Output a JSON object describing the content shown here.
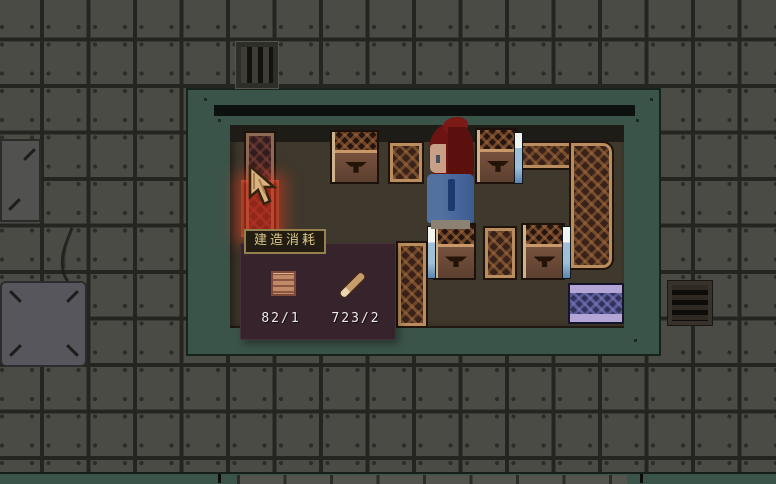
{
  "tooltip": {
    "title": "建造消耗",
    "items": [
      {
        "icon": "wood-plank-icon",
        "label": "82/1"
      },
      {
        "icon": "stick-icon",
        "label": "723/2"
      }
    ]
  },
  "icons": {
    "cursor": "pointer-arrow-icon",
    "vent_top": "vent-vertical-icon",
    "vent_right": "vent-horizontal-icon"
  },
  "colors": {
    "highlight_red": "#de2d16",
    "building_green": "#3b544a",
    "floor_brown": "#3f382c",
    "tile_gray": "#4b4b46",
    "rattan_tan": "#b98d5d",
    "tooltip_bg": "#37232b",
    "badge_border": "#93824e",
    "badge_text": "#d9c98c",
    "cost_text": "#ececec",
    "bed_purple": "#b3a6d6",
    "bed_navy": "#32325c"
  }
}
